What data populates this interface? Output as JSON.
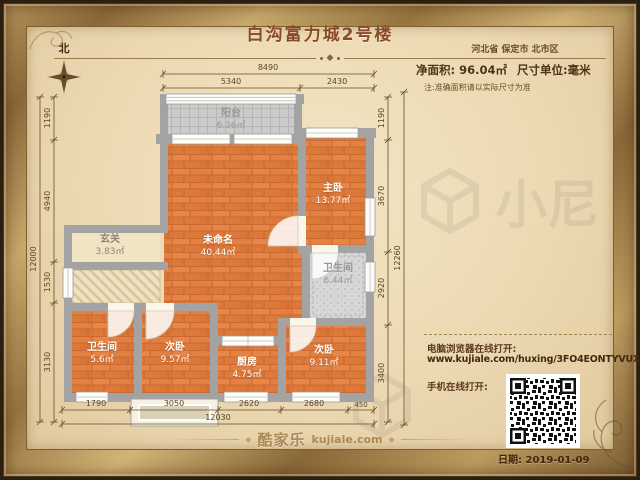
{
  "title": "白沟富力城2号楼",
  "location": "河北省 保定市 北市区",
  "area_info": {
    "net_area_label": "净面积:",
    "net_area_value": "96.04㎡",
    "unit_label": "尺寸单位:毫米",
    "note": "注:准确面积请以实际尺寸为准"
  },
  "compass": {
    "north": "北"
  },
  "rooms": {
    "balcony": {
      "name": "阳台",
      "area": "6.36㎡"
    },
    "living": {
      "name": "未命名",
      "area": "40.44㎡"
    },
    "master": {
      "name": "主卧",
      "area": "13.77㎡"
    },
    "bath_main": {
      "name": "卫生间",
      "area": "6.44㎡"
    },
    "entry": {
      "name": "玄关",
      "area": "3.83㎡"
    },
    "bath_small": {
      "name": "卫生间",
      "area": "5.6㎡"
    },
    "bedroom2": {
      "name": "次卧",
      "area": "9.57㎡"
    },
    "kitchen": {
      "name": "厨房",
      "area": "4.75㎡"
    },
    "bedroom3": {
      "name": "次卧",
      "area": "9.11㎡"
    }
  },
  "dims": {
    "top": {
      "total": "8490",
      "segs": [
        "5340",
        "2430"
      ]
    },
    "bottom": {
      "total": "12030",
      "segs": [
        "1790",
        "3050",
        "2620",
        "2680",
        "450"
      ]
    },
    "left": {
      "total": "12000",
      "segs": [
        "1190",
        "4940",
        "1530",
        "3130"
      ]
    },
    "right": {
      "total": "12260",
      "segs": [
        "1190",
        "3670",
        "2920",
        "3400"
      ]
    }
  },
  "share": {
    "pc_label": "电脑浏览器在线打开:",
    "url": "www.kujiale.com/huxing/3FO4EONTYVUX",
    "mobile_label": "手机在线打开:"
  },
  "footer": {
    "brand": "酷家乐",
    "brand_domain": "kujiale.com",
    "date_label": "日期: 2019-01-09"
  },
  "watermark": "小尼",
  "colors": {
    "wood_floor": "#e2813f",
    "wall": "#a3a3a3",
    "tile": "#cbcbcb",
    "frame_gold": "#b6935a",
    "parchment": "#ecd9b2",
    "text_brown": "#5a3a1e",
    "title_brown": "#8a4a26"
  }
}
